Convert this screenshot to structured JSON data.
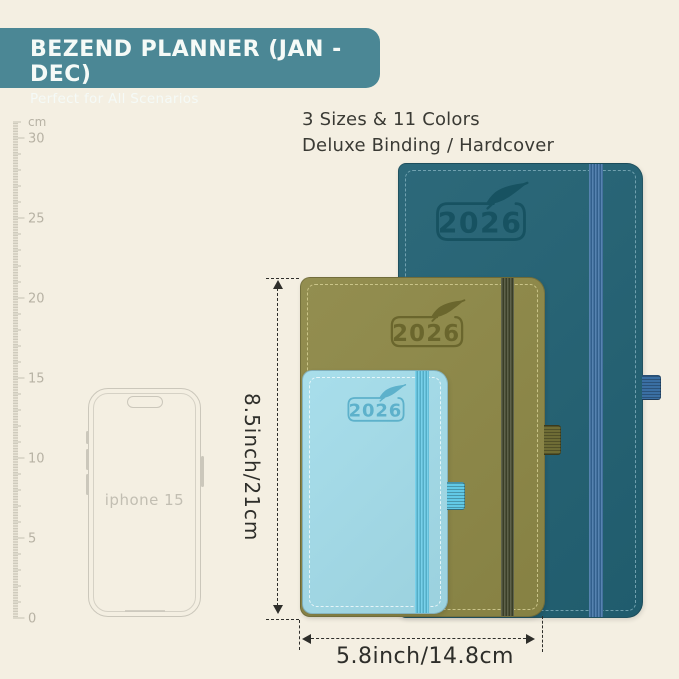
{
  "banner": {
    "title": "BEZEND PLANNER (JAN - DEC)",
    "subtitle": "Perfect for All Scenarios"
  },
  "headline": {
    "line1": "3 Sizes & 11 Colors",
    "line2": "Deluxe Binding / Hardcover"
  },
  "ruler": {
    "unit_label": "cm",
    "max_cm": 31,
    "label_step": 5,
    "labels": [
      "0",
      "5",
      "10",
      "15",
      "20",
      "25",
      "30"
    ],
    "px_per_cm": 16
  },
  "phone": {
    "label": "iphone 15"
  },
  "planners": [
    {
      "id": "large",
      "year": "2026",
      "colors": {
        "cover": "#226173",
        "logo": "#15505f",
        "band": "#3a6fa3",
        "stitch": "#7eacba",
        "loop": "#3a6fa3"
      }
    },
    {
      "id": "medium",
      "year": "2026",
      "colors": {
        "cover": "#8d8847",
        "logo": "#67632a",
        "band": "#43482d",
        "stitch": "#d5cf94",
        "loop": "#6e6c35"
      }
    },
    {
      "id": "small",
      "year": "2026",
      "colors": {
        "cover": "#a3dcea",
        "logo": "#56adc8",
        "band": "#62c9e6",
        "stitch": "#f2fbfd",
        "loop": "#62c9e6"
      }
    }
  ],
  "dimensions": {
    "height_label": "8.5inch/21cm",
    "width_label": "5.8inch/14.8cm"
  },
  "colors": {
    "bg": "#f4efe2",
    "banner": "#4b8795",
    "banner-text": "#f5faf7",
    "text": "#3a3a34",
    "ruler": "#c5c0b2",
    "ruler-label": "#b7b2a4",
    "phone": "#cbc7bb",
    "dim": "#2e2e2a"
  }
}
